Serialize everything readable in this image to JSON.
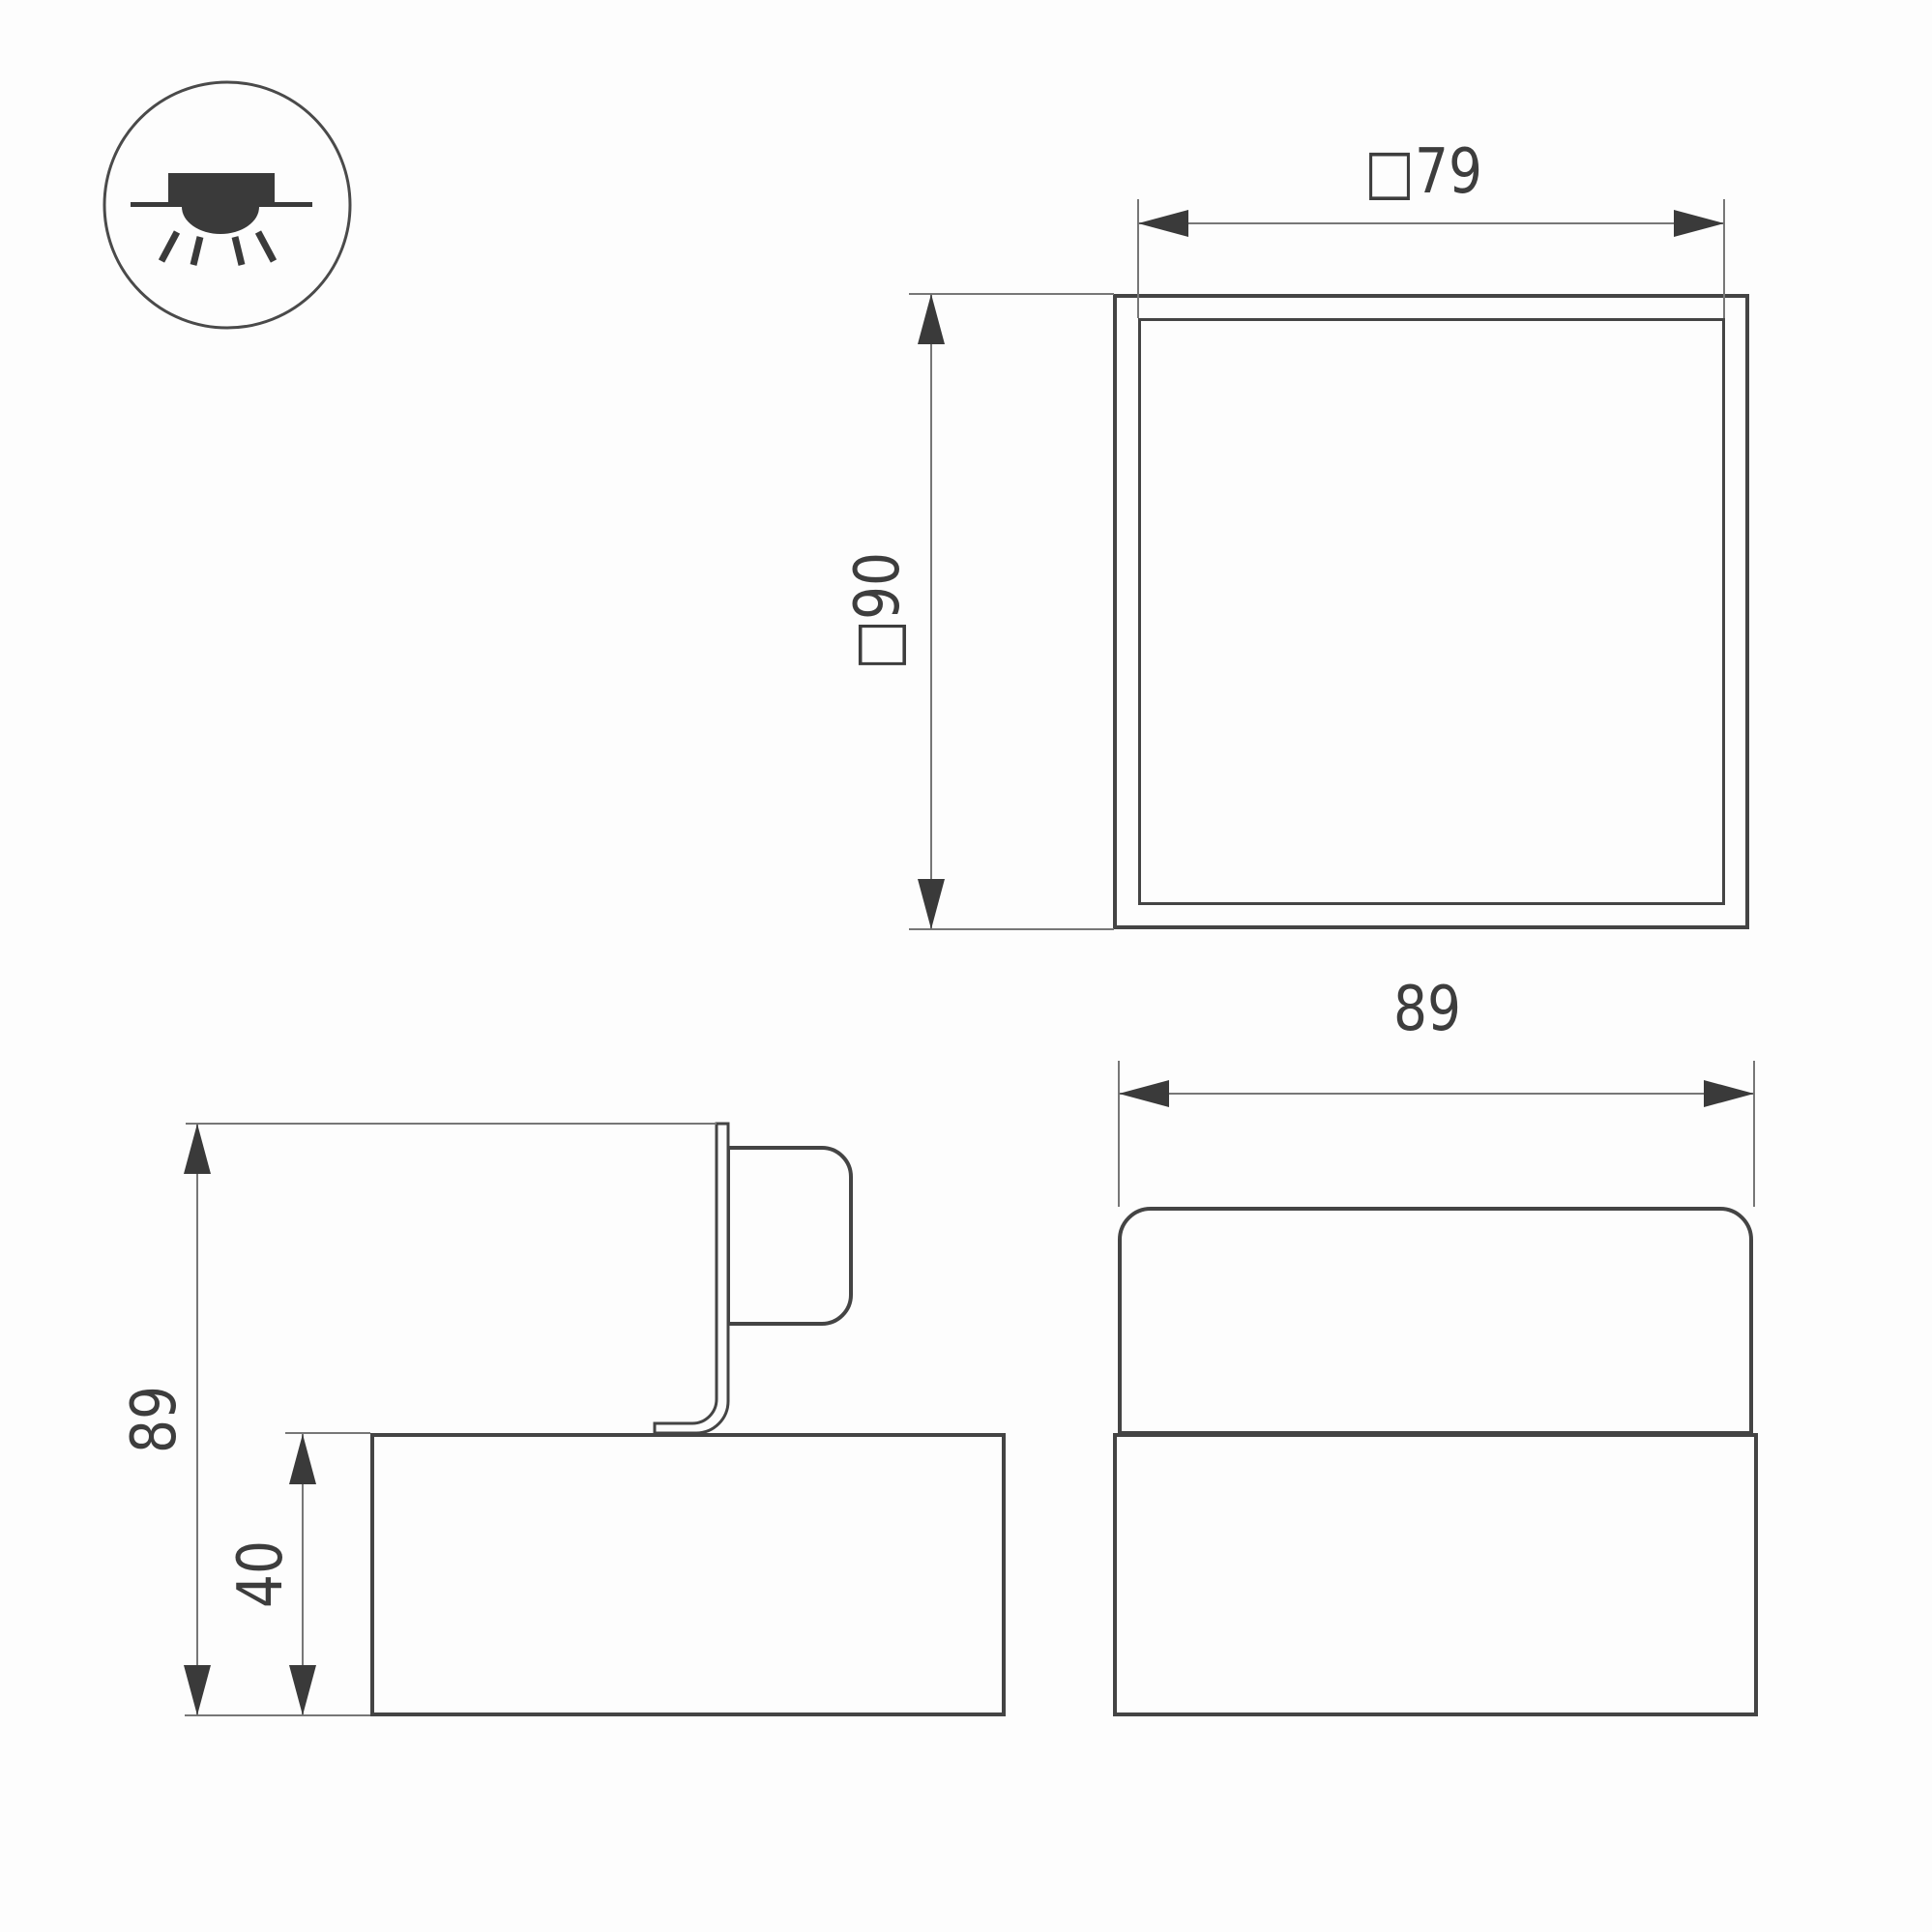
{
  "views": {
    "top": {
      "width_label": "□79",
      "height_label": "□90"
    },
    "side": {
      "height_label": "89",
      "base_height_label": "40"
    },
    "front": {
      "width_label": "89"
    }
  },
  "dimensions_mm": {
    "top_view_inner_width": 79,
    "top_view_outer_size": 90,
    "side_view_total_height": 89,
    "side_view_base_height": 40,
    "front_view_width": 89
  },
  "colors": {
    "outline": "#444444",
    "dimension_line": "#777777",
    "arrow": "#3a3a3a",
    "text": "#3d3d3d",
    "background": "#fdfdfd"
  }
}
